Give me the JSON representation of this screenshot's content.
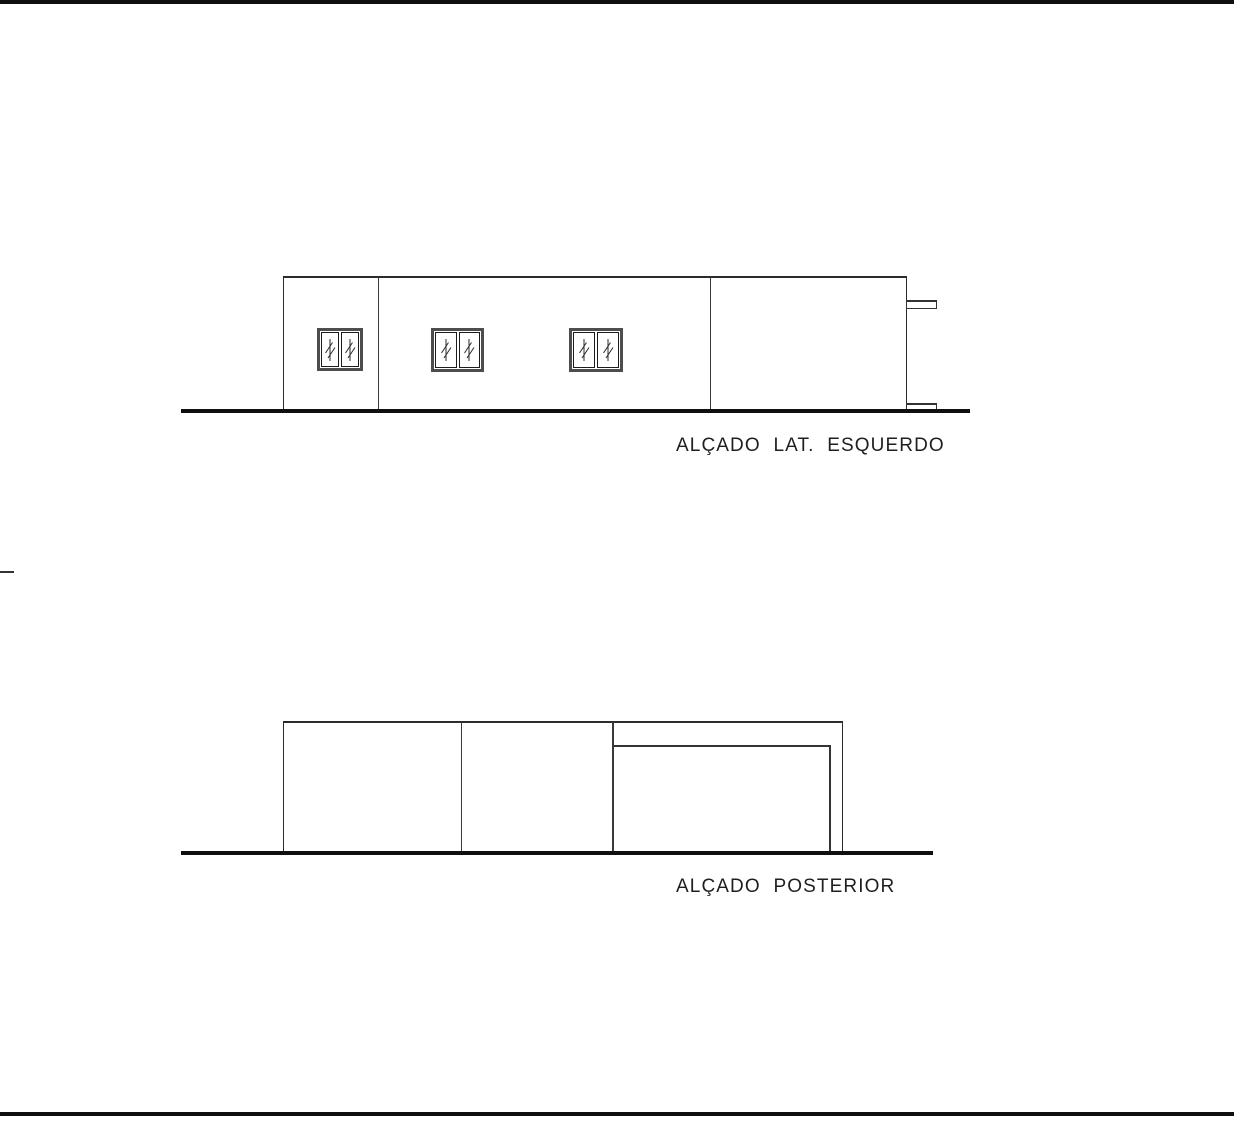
{
  "sheet": {
    "background": "#ffffff",
    "ink_color": "#1a1a1a",
    "ground_line_color": "#111111",
    "window_frame_color": "#4d4d4d"
  },
  "elevations": [
    {
      "id": "lateral-esquerdo",
      "caption": "ALÇADO  LAT.  ESQUERDO"
    },
    {
      "id": "posterior",
      "caption": "ALÇADO  POSTERIOR"
    }
  ]
}
